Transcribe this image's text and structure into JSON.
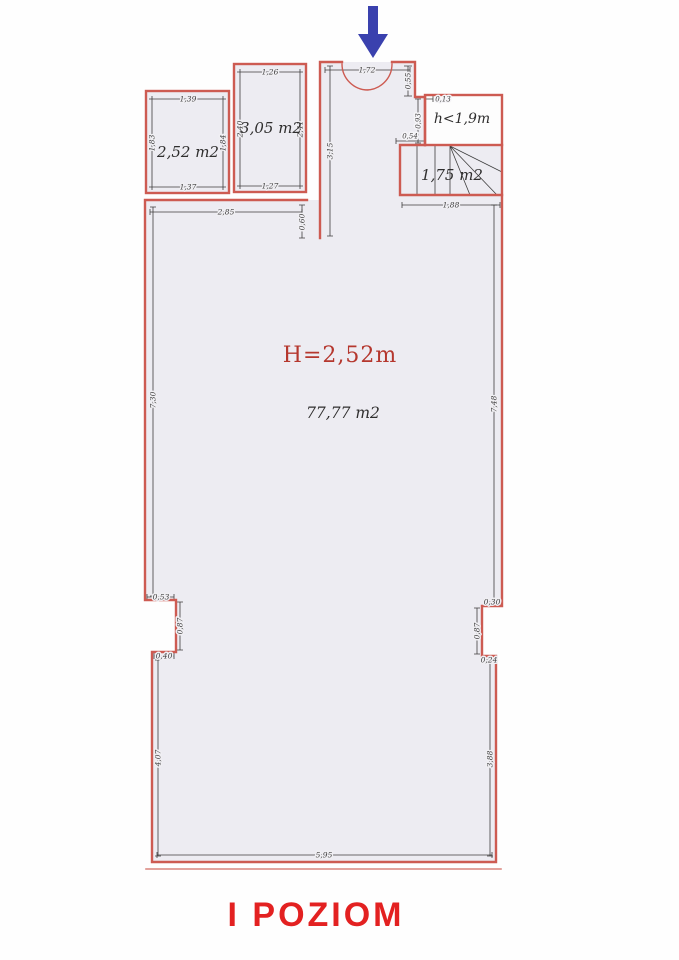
{
  "title": "I POZIOM",
  "colors": {
    "wall_red": "#cd5b52",
    "wall_red_light": "#e2837b",
    "dim": "#3f3e3e",
    "floor": "#edecf2",
    "room_white": "#fdfdfd",
    "label_red": "#b5372e",
    "title_red": "#e32121",
    "arrow_blue": "#3a41ae",
    "text_dark": "#2f2e2e"
  },
  "entrance": {
    "arrow_direction": "down"
  },
  "rooms": {
    "room_252": {
      "area": "2,52 m2",
      "dim_top": "1,39",
      "dim_bottom": "1,37",
      "dim_left": "1,83",
      "dim_right": "1,84"
    },
    "room_305": {
      "area": "3,05 m2",
      "dim_top": "1,26",
      "dim_bottom": "1,27",
      "dim_left": "2,40",
      "dim_right": "2,41"
    },
    "vestibule": {
      "door_width": "1,72",
      "dim_right": "0,55",
      "dim_left_wall": "3,15"
    },
    "attic": {
      "label": "h<1,9m",
      "dim_step": "0,13",
      "dim_left": "0,93",
      "dim_offset": "0,54"
    },
    "stairs": {
      "area": "1,75 m2",
      "dim_bottom": "1,88"
    },
    "main": {
      "height_label": "H=2,52m",
      "area": "77,77 m2",
      "dim_top": "2,85",
      "dim_top_offset": "0,60",
      "dim_left_upper": "7,30",
      "dim_right_upper": "7,48",
      "notch_left": {
        "a": "0,53",
        "b": "0,87",
        "c": "0,40"
      },
      "notch_right": {
        "a": "0,30",
        "b": "0,87",
        "c": "0,24"
      },
      "dim_left_lower": "4,07",
      "dim_right_lower": "3,88",
      "dim_bottom": "5,95"
    }
  }
}
